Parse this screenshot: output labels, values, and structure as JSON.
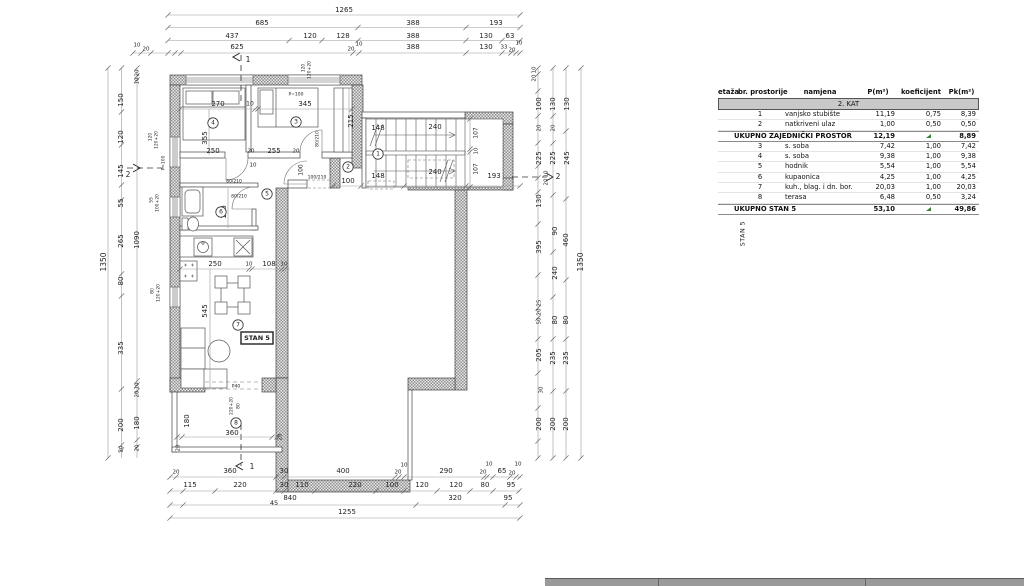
{
  "plan": {
    "labels": [
      [
        "1265",
        344,
        10
      ],
      [
        "685",
        262,
        23
      ],
      [
        "388",
        413,
        23
      ],
      [
        "193",
        496,
        23
      ],
      [
        "437",
        232,
        36
      ],
      [
        "120",
        310,
        36
      ],
      [
        "128",
        343,
        36
      ],
      [
        "388",
        413,
        36
      ],
      [
        "130",
        486,
        36
      ],
      [
        "63",
        510,
        36
      ],
      [
        "10",
        137,
        45,
        0,
        5.5
      ],
      [
        "20",
        146,
        49,
        0,
        5.5
      ],
      [
        "625",
        237,
        47
      ],
      [
        "20",
        351,
        49,
        0,
        5.5
      ],
      [
        "10",
        359,
        44,
        0,
        5.5
      ],
      [
        "388",
        413,
        47
      ],
      [
        "130",
        486,
        47
      ],
      [
        "33",
        504,
        47,
        0,
        5.5
      ],
      [
        "20",
        512,
        50,
        0,
        5.5
      ],
      [
        "10",
        519,
        43,
        0,
        5.5
      ],
      [
        "1",
        248,
        60,
        0,
        7.5
      ],
      [
        "1",
        252,
        467,
        0,
        7.5
      ],
      [
        "2",
        128,
        175,
        0,
        7.5
      ],
      [
        "2",
        558,
        177,
        0,
        7.5
      ],
      [
        "1350",
        104,
        262,
        -90,
        7.5
      ],
      [
        "150",
        121,
        100,
        -90
      ],
      [
        "120",
        121,
        137,
        -90
      ],
      [
        "145",
        121,
        171,
        -90
      ],
      [
        "55",
        121,
        203,
        -90
      ],
      [
        "265",
        121,
        241,
        -90
      ],
      [
        "80",
        121,
        281,
        -90
      ],
      [
        "335",
        121,
        348,
        -90
      ],
      [
        "200",
        121,
        425,
        -90
      ],
      [
        "20",
        121,
        449,
        -90,
        5.5
      ],
      [
        "20",
        137,
        73,
        -90,
        5.5
      ],
      [
        "10",
        137,
        81,
        -90,
        5.5
      ],
      [
        "1090",
        137,
        240,
        -90
      ],
      [
        "10",
        137,
        386,
        -90,
        5.5
      ],
      [
        "20",
        137,
        394,
        -90,
        5.5
      ],
      [
        "180",
        137,
        423,
        -90
      ],
      [
        "20",
        137,
        448,
        -90,
        5.5
      ],
      [
        "10",
        534,
        70,
        -90,
        5.5
      ],
      [
        "20",
        534,
        78,
        -90,
        5.5
      ],
      [
        "100",
        539,
        104,
        -90
      ],
      [
        "20",
        539,
        128,
        -90,
        5.5
      ],
      [
        "225",
        539,
        158,
        -90
      ],
      [
        "10",
        546,
        174,
        -90,
        5.5
      ],
      [
        "20",
        546,
        182,
        -90,
        5.5
      ],
      [
        "130",
        539,
        201,
        -90
      ],
      [
        "395",
        539,
        247,
        -90
      ],
      [
        "25",
        539,
        303,
        -90,
        5.5
      ],
      [
        "20",
        539,
        312,
        -90,
        5.5
      ],
      [
        "50",
        539,
        321,
        -90,
        5.5
      ],
      [
        "205",
        539,
        355,
        -90
      ],
      [
        "30",
        541,
        390,
        -90,
        5.5
      ],
      [
        "200",
        539,
        424,
        -90
      ],
      [
        "130",
        553,
        104,
        -90
      ],
      [
        "20",
        553,
        128,
        -90,
        5.5
      ],
      [
        "225",
        553,
        158,
        -90
      ],
      [
        "90",
        555,
        231,
        -90
      ],
      [
        "240",
        555,
        273,
        -90
      ],
      [
        "80",
        555,
        320,
        -90
      ],
      [
        "235",
        553,
        358,
        -90
      ],
      [
        "200",
        553,
        424,
        -90
      ],
      [
        "130",
        567,
        104,
        -90
      ],
      [
        "245",
        567,
        158,
        -90
      ],
      [
        "460",
        566,
        240,
        -90
      ],
      [
        "80",
        566,
        320,
        -90
      ],
      [
        "235",
        566,
        358,
        -90
      ],
      [
        "200",
        566,
        424,
        -90
      ],
      [
        "1350",
        581,
        262,
        -90,
        7.5
      ],
      [
        "20",
        176,
        472,
        0,
        5.5
      ],
      [
        "360",
        230,
        471
      ],
      [
        "30",
        284,
        471
      ],
      [
        "400",
        343,
        471
      ],
      [
        "10",
        404,
        465,
        0,
        5.5
      ],
      [
        "20",
        398,
        472,
        0,
        5.5
      ],
      [
        "290",
        446,
        471
      ],
      [
        "10",
        489,
        464,
        0,
        5.5
      ],
      [
        "20",
        483,
        472,
        0,
        5.5
      ],
      [
        "65",
        502,
        471
      ],
      [
        "20",
        512,
        473,
        0,
        5.5
      ],
      [
        "10",
        518,
        464,
        0,
        5.5
      ],
      [
        "115",
        190,
        485
      ],
      [
        "220",
        240,
        485
      ],
      [
        "30",
        284,
        485
      ],
      [
        "110",
        302,
        485
      ],
      [
        "220",
        355,
        485
      ],
      [
        "100",
        392,
        485
      ],
      [
        "120",
        422,
        485
      ],
      [
        "120",
        456,
        485
      ],
      [
        "80",
        485,
        485
      ],
      [
        "95",
        511,
        485
      ],
      [
        "45",
        274,
        503,
        0,
        6.5
      ],
      [
        "840",
        290,
        498
      ],
      [
        "320",
        455,
        498
      ],
      [
        "95",
        508,
        498
      ],
      [
        "1255",
        347,
        512
      ],
      [
        "270",
        218,
        104
      ],
      [
        "10",
        250,
        104,
        0,
        6
      ],
      [
        "345",
        305,
        104
      ],
      [
        "355",
        205,
        138,
        -90
      ],
      [
        "215",
        351,
        121,
        -90
      ],
      [
        "250",
        213,
        151
      ],
      [
        "20",
        251,
        151,
        0,
        5.5
      ],
      [
        "255",
        274,
        151
      ],
      [
        "20",
        296,
        151,
        0,
        5.5
      ],
      [
        "10",
        253,
        165,
        0,
        5.5
      ],
      [
        "148",
        378,
        128
      ],
      [
        "148",
        378,
        176
      ],
      [
        "240",
        435,
        127
      ],
      [
        "240",
        435,
        172
      ],
      [
        "107",
        476,
        133,
        -90,
        6
      ],
      [
        "10",
        476,
        151,
        -90,
        5.5
      ],
      [
        "107",
        476,
        169,
        -90,
        6
      ],
      [
        "193",
        494,
        176
      ],
      [
        "100",
        301,
        170,
        -90,
        6
      ],
      [
        "100",
        348,
        181
      ],
      [
        "80/210",
        234,
        181,
        0,
        4.5
      ],
      [
        "80/210",
        239,
        196,
        0,
        4.5
      ],
      [
        "80/210",
        317,
        139,
        -90,
        4.5
      ],
      [
        "100/210",
        317,
        177,
        0,
        4.5
      ],
      [
        "P=100",
        296,
        94,
        0,
        4.5
      ],
      [
        "120",
        303,
        68,
        -90,
        4.5
      ],
      [
        "120+20",
        309,
        70,
        -90,
        4.5
      ],
      [
        "120",
        150,
        137,
        -90,
        4.5
      ],
      [
        "120+20",
        156,
        140,
        -90,
        4.5
      ],
      [
        "55",
        151,
        200,
        -90,
        4.5
      ],
      [
        "100+20",
        157,
        203,
        -90,
        4.5
      ],
      [
        "80",
        152,
        291,
        -90,
        4.5
      ],
      [
        "120+20",
        158,
        293,
        -90,
        4.5
      ],
      [
        "P=100",
        163,
        163,
        -90,
        4.5
      ],
      [
        "250",
        215,
        264
      ],
      [
        "10",
        249,
        264,
        0,
        5.5
      ],
      [
        "108",
        269,
        264
      ],
      [
        "10",
        284,
        264,
        0,
        5.5
      ],
      [
        "545",
        205,
        311,
        -90
      ],
      [
        "170",
        224,
        212,
        -90
      ],
      [
        "360",
        232,
        433
      ],
      [
        "180",
        187,
        421,
        -90
      ],
      [
        "20",
        178,
        448,
        -90,
        5.5
      ],
      [
        "20",
        280,
        437,
        -90,
        5.5
      ],
      [
        "P40",
        236,
        386,
        0,
        4.5
      ],
      [
        "220+20",
        231,
        406,
        -90,
        4.5
      ],
      [
        "80",
        238,
        406,
        -90,
        4.5
      ],
      [
        "1",
        378,
        154,
        0,
        6,
        "c"
      ],
      [
        "2",
        348,
        167,
        0,
        6,
        "c"
      ],
      [
        "3",
        296,
        122,
        0,
        6,
        "c"
      ],
      [
        "4",
        213,
        123,
        0,
        6,
        "c"
      ],
      [
        "5",
        267,
        194,
        0,
        6,
        "c"
      ],
      [
        "6",
        221,
        212,
        0,
        6,
        "c"
      ],
      [
        "7",
        238,
        325,
        0,
        6,
        "c"
      ],
      [
        "8",
        236,
        423,
        0,
        6,
        "c"
      ],
      [
        "STAN 5",
        257,
        338,
        0,
        6.5,
        "box"
      ]
    ]
  },
  "table": {
    "headers": [
      "etaža",
      "br. prostorije",
      "namjena",
      "P(m²)",
      "koeficijent",
      "Pk(m²)"
    ],
    "floor_band": "2. KAT",
    "group_label": "STAN 5",
    "marker_color": "#2f8b2f",
    "rows": [
      {
        "type": "item",
        "br": "1",
        "namjena": "vanjsko stubište",
        "p": "11,19",
        "koef": "0,75",
        "pk": "8,39"
      },
      {
        "type": "item",
        "br": "2",
        "namjena": "natkriveni ulaz",
        "p": "1,00",
        "koef": "0,50",
        "pk": "0,50"
      },
      {
        "type": "total",
        "label": "UKUPNO ZAJEDNIČKI PROSTOR",
        "p": "12,19",
        "koef": "",
        "pk": "8,89",
        "marker": true
      },
      {
        "type": "item",
        "br": "3",
        "namjena": "s. soba",
        "p": "7,42",
        "koef": "1,00",
        "pk": "7,42"
      },
      {
        "type": "item",
        "br": "4",
        "namjena": "s. soba",
        "p": "9,38",
        "koef": "1,00",
        "pk": "9,38"
      },
      {
        "type": "item",
        "br": "5",
        "namjena": "hodnik",
        "p": "5,54",
        "koef": "1,00",
        "pk": "5,54"
      },
      {
        "type": "item",
        "br": "6",
        "namjena": "kupaonica",
        "p": "4,25",
        "koef": "1,00",
        "pk": "4,25"
      },
      {
        "type": "item",
        "br": "7",
        "namjena": "kuh., blag. i dn. bor.",
        "p": "20,03",
        "koef": "1,00",
        "pk": "20,03"
      },
      {
        "type": "item",
        "br": "8",
        "namjena": "terasa",
        "p": "6,48",
        "koef": "0,50",
        "pk": "3,24"
      },
      {
        "type": "total",
        "label": "UKUPNO STAN 5",
        "p": "53,10",
        "koef": "",
        "pk": "49,86",
        "marker": true
      }
    ]
  }
}
